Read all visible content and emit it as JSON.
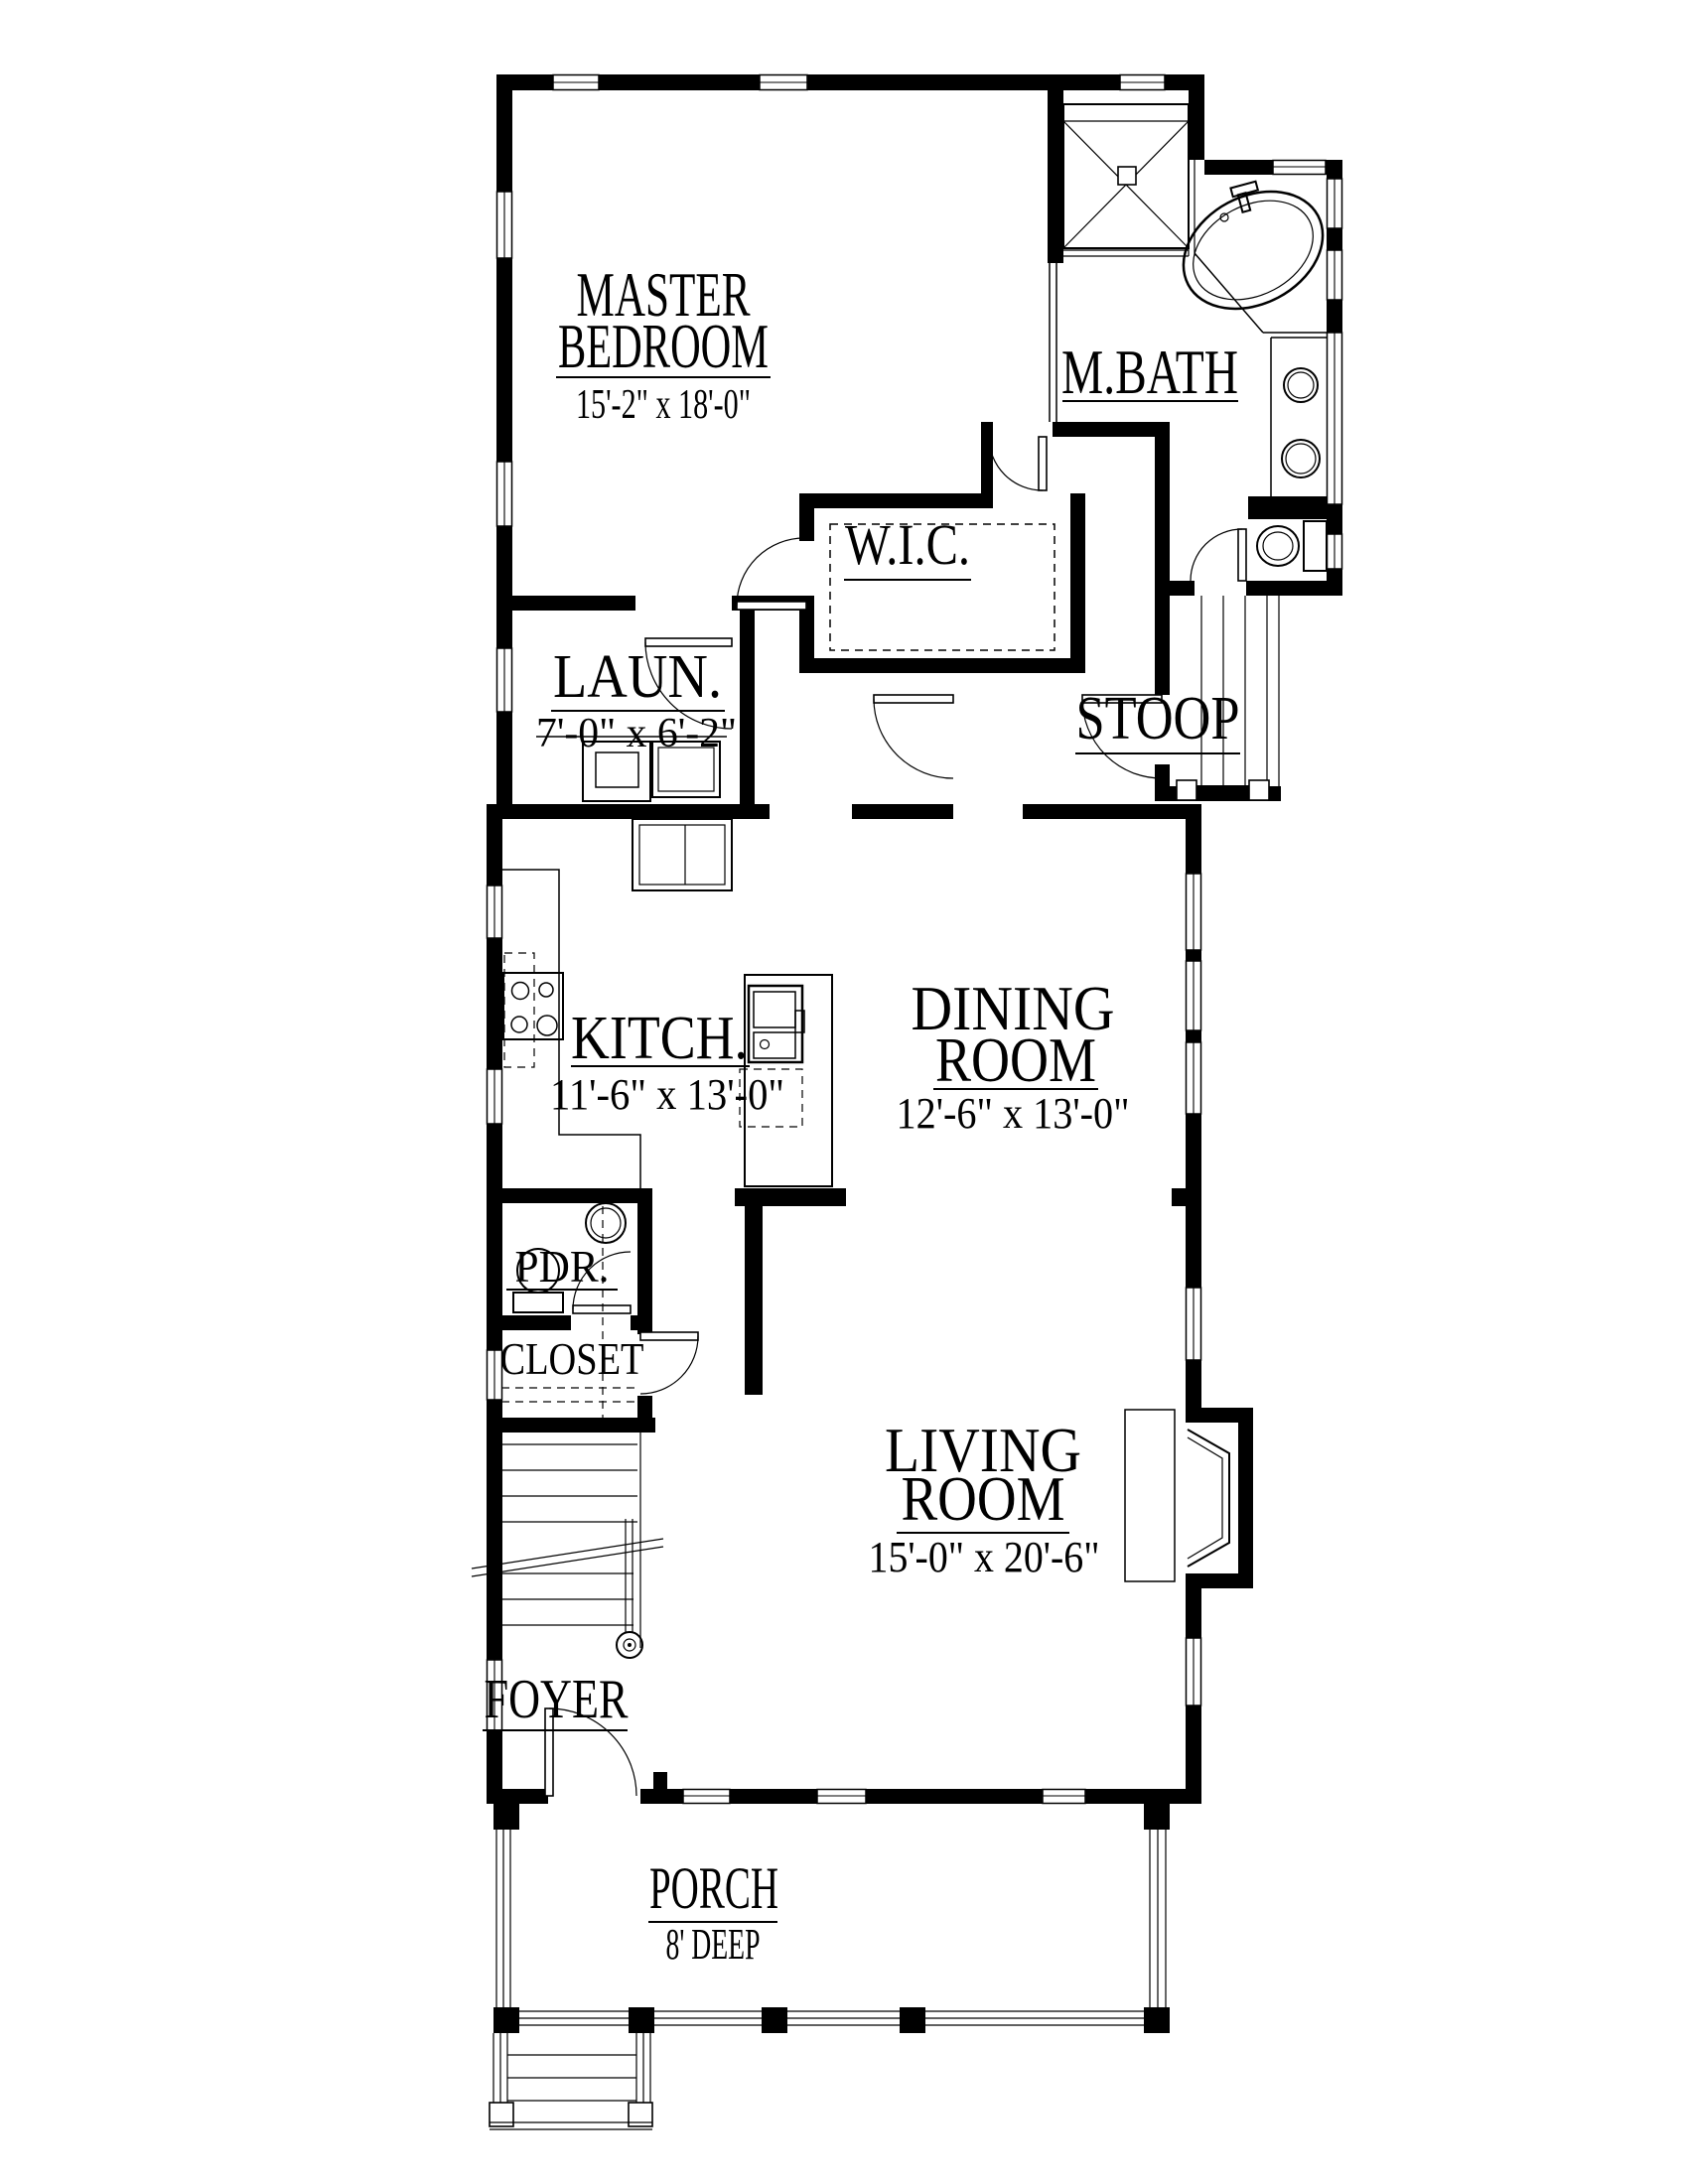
{
  "meta": {
    "drawing_type": "first floor plan",
    "ink_color": "#000000",
    "paper_color": "#ffffff"
  },
  "rooms": {
    "master": {
      "line1": "MASTER",
      "line2": "BEDROOM",
      "dims": "15'-2\" x 18'-0\""
    },
    "mbath": {
      "label": "M.BATH"
    },
    "wic": {
      "label": "W.I.C."
    },
    "laundry": {
      "label": "LAUN.",
      "dims": "7'-0\" x 6'-2\""
    },
    "stoop": {
      "label": "STOOP"
    },
    "kitchen": {
      "label": "KITCH.",
      "dims": "11'-6\" x 13'-0\""
    },
    "dining": {
      "line1": "DINING",
      "line2": "ROOM",
      "dims": "12'-6\" x 13'-0\""
    },
    "pdr": {
      "label": "PDR."
    },
    "closet": {
      "label": "CLOSET"
    },
    "living": {
      "line1": "LIVING",
      "line2": "ROOM",
      "dims": "15'-0\" x 20'-6\""
    },
    "foyer": {
      "label": "FOYER"
    },
    "porch": {
      "label": "PORCH",
      "dims": "8' DEEP"
    }
  }
}
